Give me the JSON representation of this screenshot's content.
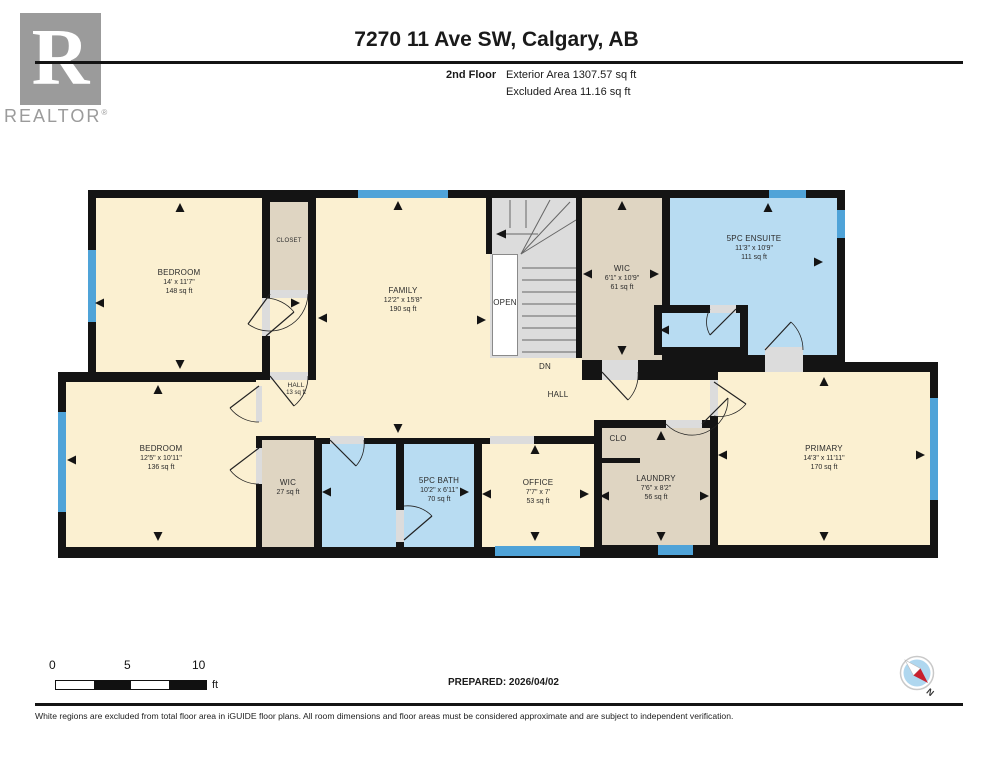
{
  "header": {
    "logo_letter": "R",
    "logo_word": "REALTOR",
    "logo_reg": "®",
    "title": "7270 11 Ave SW, Calgary, AB",
    "floor_label": "2nd Floor",
    "exterior_area": "Exterior Area 1307.57 sq ft",
    "excluded_area": "Excluded Area 11.16 sq ft"
  },
  "rooms": {
    "bedroom1": {
      "name": "BEDROOM",
      "dims": "14' x 11'7\"",
      "area": "148 sq ft"
    },
    "closet": {
      "name": "CLOSET"
    },
    "family": {
      "name": "FAMILY",
      "dims": "12'2\" x 15'8\"",
      "area": "190 sq ft"
    },
    "open": {
      "name": "OPEN"
    },
    "dn": {
      "name": "DN"
    },
    "hall": {
      "name": "HALL"
    },
    "hall_small": {
      "name": "HALL",
      "area": "13 sq ft"
    },
    "wic_top": {
      "name": "WIC",
      "dims": "6'1\" x 10'9\"",
      "area": "61 sq ft"
    },
    "ensuite": {
      "name": "5PC ENSUITE",
      "dims": "11'3\" x 10'9\"",
      "area": "111 sq ft"
    },
    "bedroom2": {
      "name": "BEDROOM",
      "dims": "12'5\" x 10'11\"",
      "area": "136 sq ft"
    },
    "wic_small": {
      "name": "WIC",
      "area": "27 sq ft"
    },
    "bath": {
      "name": "5PC BATH",
      "dims": "10'2\" x 6'11\"",
      "area": "70 sq ft"
    },
    "office": {
      "name": "OFFICE",
      "dims": "7'7\" x 7'",
      "area": "53 sq ft"
    },
    "clo": {
      "name": "CLO"
    },
    "laundry": {
      "name": "LAUNDRY",
      "dims": "7'6\" x 8'2\"",
      "area": "56 sq ft"
    },
    "primary": {
      "name": "PRIMARY",
      "dims": "14'3\" x 11'11\"",
      "area": "170 sq ft"
    }
  },
  "footer": {
    "scale": {
      "zero": "0",
      "five": "5",
      "ten": "10",
      "unit": "ft"
    },
    "prepared": "PREPARED: 2026/04/02",
    "compass_n": "N",
    "disclaimer": "White regions are excluded from total floor area in iGUIDE floor plans. All room dimensions and floor areas must be considered approximate and are subject to independent verification."
  },
  "colors": {
    "room_fill": "#FBF0D1",
    "closet_fill": "#DFD5C2",
    "bath_fill": "#B8DCF2",
    "window": "#4FA3D8",
    "wall": "#141414",
    "stairs": "#DCDCDC",
    "compass_red": "#C8202E"
  }
}
